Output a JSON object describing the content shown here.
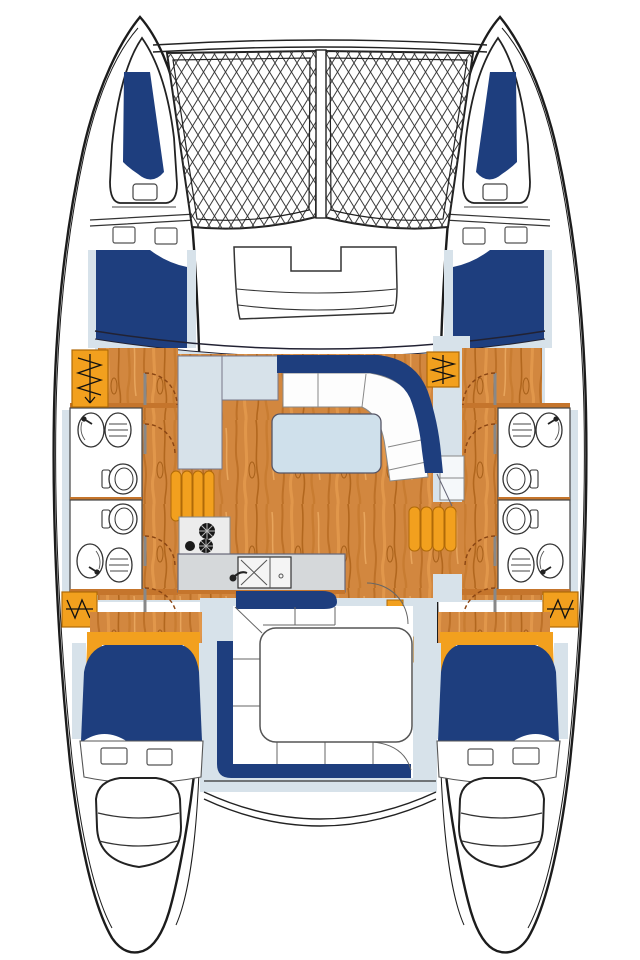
{
  "app": {
    "title": "Catamaran deck plan",
    "type": "boat floor-plan diagram",
    "text_labels": []
  },
  "colors": {
    "outline": "#1c1c1c",
    "hull_white": "#ffffff",
    "navy": "#1e3e7e",
    "deck_blue": "#d7e2ea",
    "table_blue": "#cfe0eb",
    "orange": "#f2a01e",
    "orange_edge": "#b06a08",
    "wood": "#d2873f",
    "wood_dark": "#b2671e",
    "wood_light": "#e8a55c",
    "wall_brown": "#c5752c",
    "counter_gray": "#d5d8da",
    "stove_gray": "#ececec",
    "net_line": "#3c3c3c",
    "seat_line": "#666666",
    "door_dash": "#8a4513"
  },
  "vessel": {
    "layout": "catamaran, symmetrical port/starboard hulls",
    "bow_features": [
      "port bow locker with navy cushion",
      "starboard bow locker with navy cushion",
      "two trampoline nets with center walkway",
      "forward cockpit bench with notch"
    ],
    "port_hull_spaces": [
      "bow locker",
      "forward double berth",
      "companionway stairs",
      "forward head",
      "aft head",
      "aft companionway stairs",
      "aft double berth",
      "swim platform with steps"
    ],
    "starboard_hull_spaces": [
      "bow locker",
      "forward double berth",
      "inboard companionway stairs",
      "forward head",
      "aft head",
      "aft companionway stairs",
      "aft double berth",
      "swim platform with steps"
    ],
    "bridge_deck_spaces": [
      "salon with wood floor",
      "curved navy settee",
      "dinette table",
      "L-shaped side panel",
      "galley counter with double sink",
      "three-burner stove",
      "orange cushion benches",
      "aft cockpit with L-shaped navy bench and table"
    ],
    "head_fixtures": [
      "washbasin with faucet",
      "lined oval sink",
      "toilet with tank"
    ],
    "counts": {
      "cabins": 4,
      "heads": 4,
      "trampolines": 2,
      "swim_platforms": 2,
      "cockpit_tables": 1,
      "salon_tables": 1
    }
  }
}
